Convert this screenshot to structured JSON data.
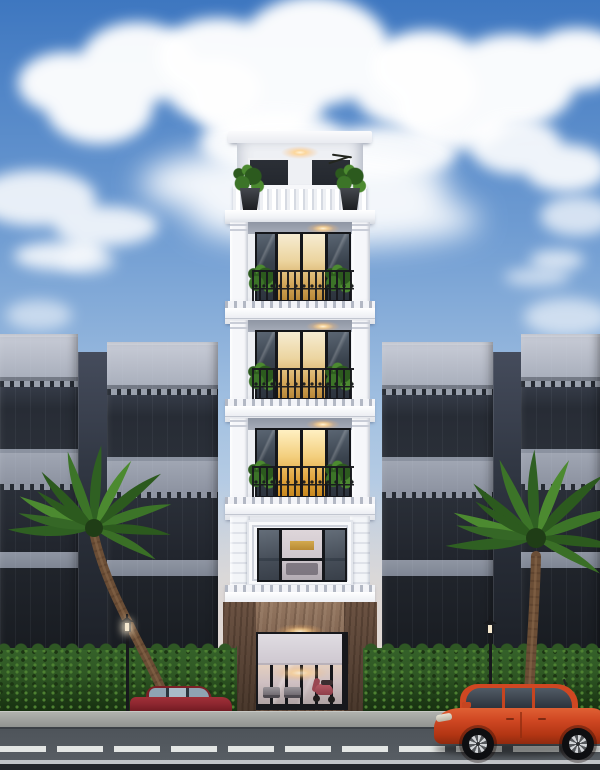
{
  "image": {
    "width": 600,
    "height": 770,
    "kind": "architectural rendering, street elevation at dusk"
  },
  "scene": {
    "description": "Narrow six-storey white neoclassical shophouse with lit interiors, flanked by grey modern townhouses, palm trees, hedge row, street lamps and two red cars on the road",
    "main_building": {
      "style": "neoclassical shophouse",
      "storeys": 6,
      "features": [
        "rooftop terrace with balustrade and planters",
        "three wrought-iron balcony floors with potted plants",
        "ornate picture-window floor",
        "stone-clad ground floor",
        "glass storefront with scooter parked inside",
        "warm ceiling downlights on every level"
      ]
    },
    "neighbors": {
      "left": 2,
      "right": 2,
      "style": "flat-roofed grey modern townhouses with dark glazing bands"
    },
    "vegetation": [
      "left palm tree",
      "right palm tree",
      "continuous green hedge"
    ],
    "street_furniture": [
      "left street lamp (lit)",
      "right street lamp"
    ],
    "vehicles": [
      {
        "type": "sedan",
        "color_name": "dark red",
        "position": "left, behind curb"
      },
      {
        "type": "hatchback",
        "color_name": "orange-red",
        "position": "right, on road"
      }
    ],
    "road": {
      "markings": "white dashed center line",
      "sidewalk": "light grey with curb"
    }
  },
  "colors": {
    "skyTop": "#3e77c0",
    "skyUpper": "#6f9cd2",
    "skyMid": "#a6c3e2",
    "skyLow": "#cdd8e6",
    "skyHorizon": "#e9ddd2",
    "cloud": "#ffffff",
    "towerWall": "#edeff3",
    "towerTrim": "#f6f7fa",
    "ceilingGrey": "#9ca3b0",
    "frameDark": "#14161a",
    "ironDark": "#17181d",
    "glassDark": "#39424d",
    "glassWarm": "#ecd5a0",
    "glassGold": "#e0a33c",
    "plantDark": "#2c5a1e",
    "plantMid": "#3c7428",
    "plantLight": "#4c8a30",
    "stoneHi": "#937660",
    "stoneLo": "#5d4839",
    "hedgeHi": "#4e8132",
    "hedgeMid": "#2f5724",
    "hedgeLo": "#142c0e",
    "trunkBrown": "#6b4e36",
    "roadGrey": "#4e545a",
    "sidewalkHi": "#b0b2ae",
    "sidewalkLo": "#8e918e",
    "curb": "#5f6368",
    "lane": "#eef1ee",
    "sedanRed": "#8e2730",
    "hatchOrange": "#cf4722",
    "hatchDark": "#b23513",
    "lampBlack": "#17181c",
    "warmLight": "#ffd9a0"
  }
}
